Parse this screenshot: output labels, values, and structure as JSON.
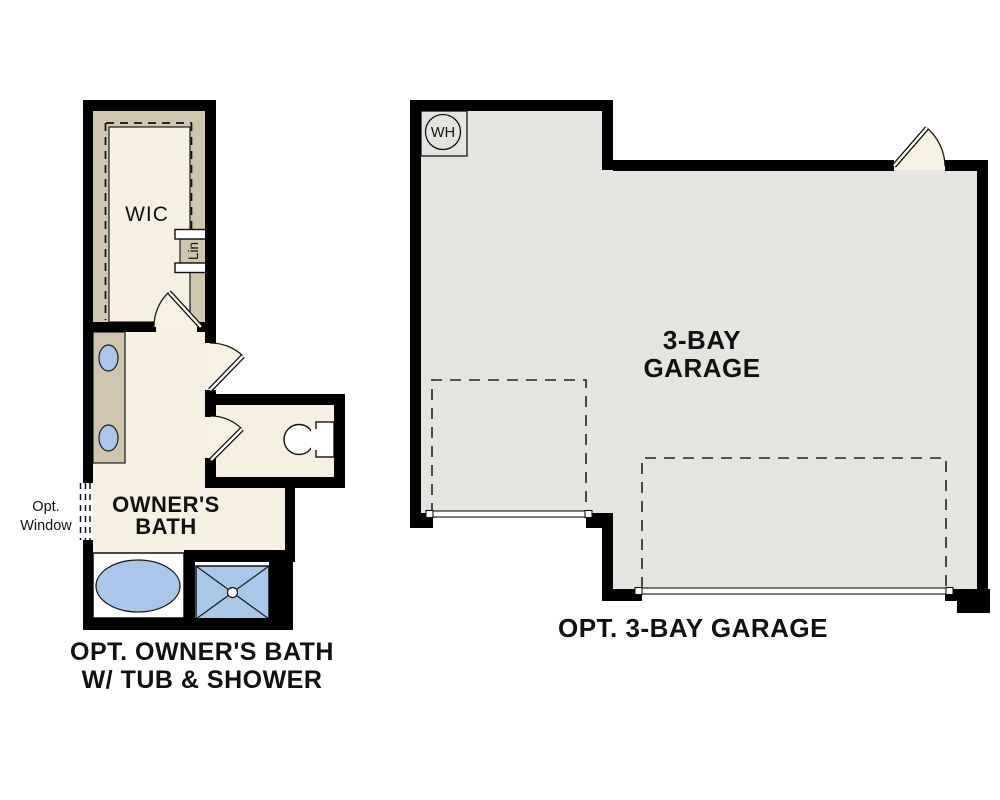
{
  "bath_plan": {
    "caption_line1": "OPT. OWNER'S BATH",
    "caption_line2": "W/ TUB & SHOWER",
    "room_label_line1": "OWNER'S",
    "room_label_line2": "BATH",
    "closet_label": "WIC",
    "linen_label": "Lin",
    "window_label_line1": "Opt.",
    "window_label_line2": "Window"
  },
  "garage_plan": {
    "caption": "OPT. 3-BAY GARAGE",
    "room_label_line1": "3-BAY",
    "room_label_line2": "GARAGE",
    "water_heater_label": "WH"
  },
  "colors": {
    "wall": "#000000",
    "floor_cream": "#f6f0e2",
    "closet_tan": "#d0c5ae",
    "garage_gray": "#e5e4e1",
    "fixture_blue": "#a9c8e9",
    "door_fill": "#f7f1e3"
  }
}
